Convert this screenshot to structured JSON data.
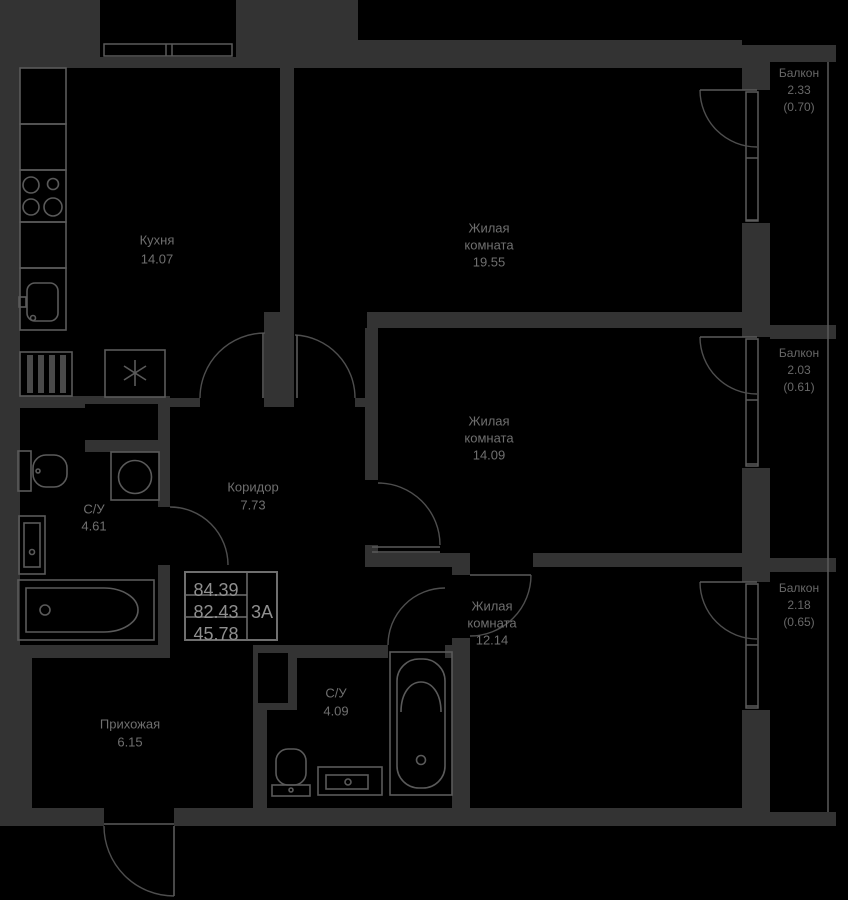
{
  "plan": {
    "title": "apartment-floor-plan",
    "info_box": {
      "total_area": "84.39",
      "area_without_balconies": "82.43",
      "living_area": "45.78",
      "flat_type": "3А"
    },
    "rooms": {
      "kitchen": {
        "name": "Кухня",
        "area": "14.07"
      },
      "living1": {
        "name_l1": "Жилая",
        "name_l2": "комната",
        "area": "19.55"
      },
      "living2": {
        "name_l1": "Жилая",
        "name_l2": "комната",
        "area": "14.09"
      },
      "living3": {
        "name_l1": "Жилая",
        "name_l2": "комната",
        "area": "12.14"
      },
      "corridor": {
        "name": "Коридор",
        "area": "7.73"
      },
      "bathroom1": {
        "name": "С/У",
        "area": "4.61"
      },
      "bathroom2": {
        "name": "С/У",
        "area": "4.09"
      },
      "hallway": {
        "name": "Прихожая",
        "area": "6.15"
      }
    },
    "balconies": {
      "b1": {
        "name": "Балкон",
        "area": "2.33",
        "reduced": "(0.70)"
      },
      "b2": {
        "name": "Балкон",
        "area": "2.03",
        "reduced": "(0.61)"
      },
      "b3": {
        "name": "Балкон",
        "area": "2.18",
        "reduced": "(0.65)"
      }
    },
    "colors": {
      "background": "#000000",
      "wall": "#333333",
      "line": "#5a5a5a",
      "label_text": "#6f6f6f",
      "info_text": "#8f8f8f"
    }
  }
}
